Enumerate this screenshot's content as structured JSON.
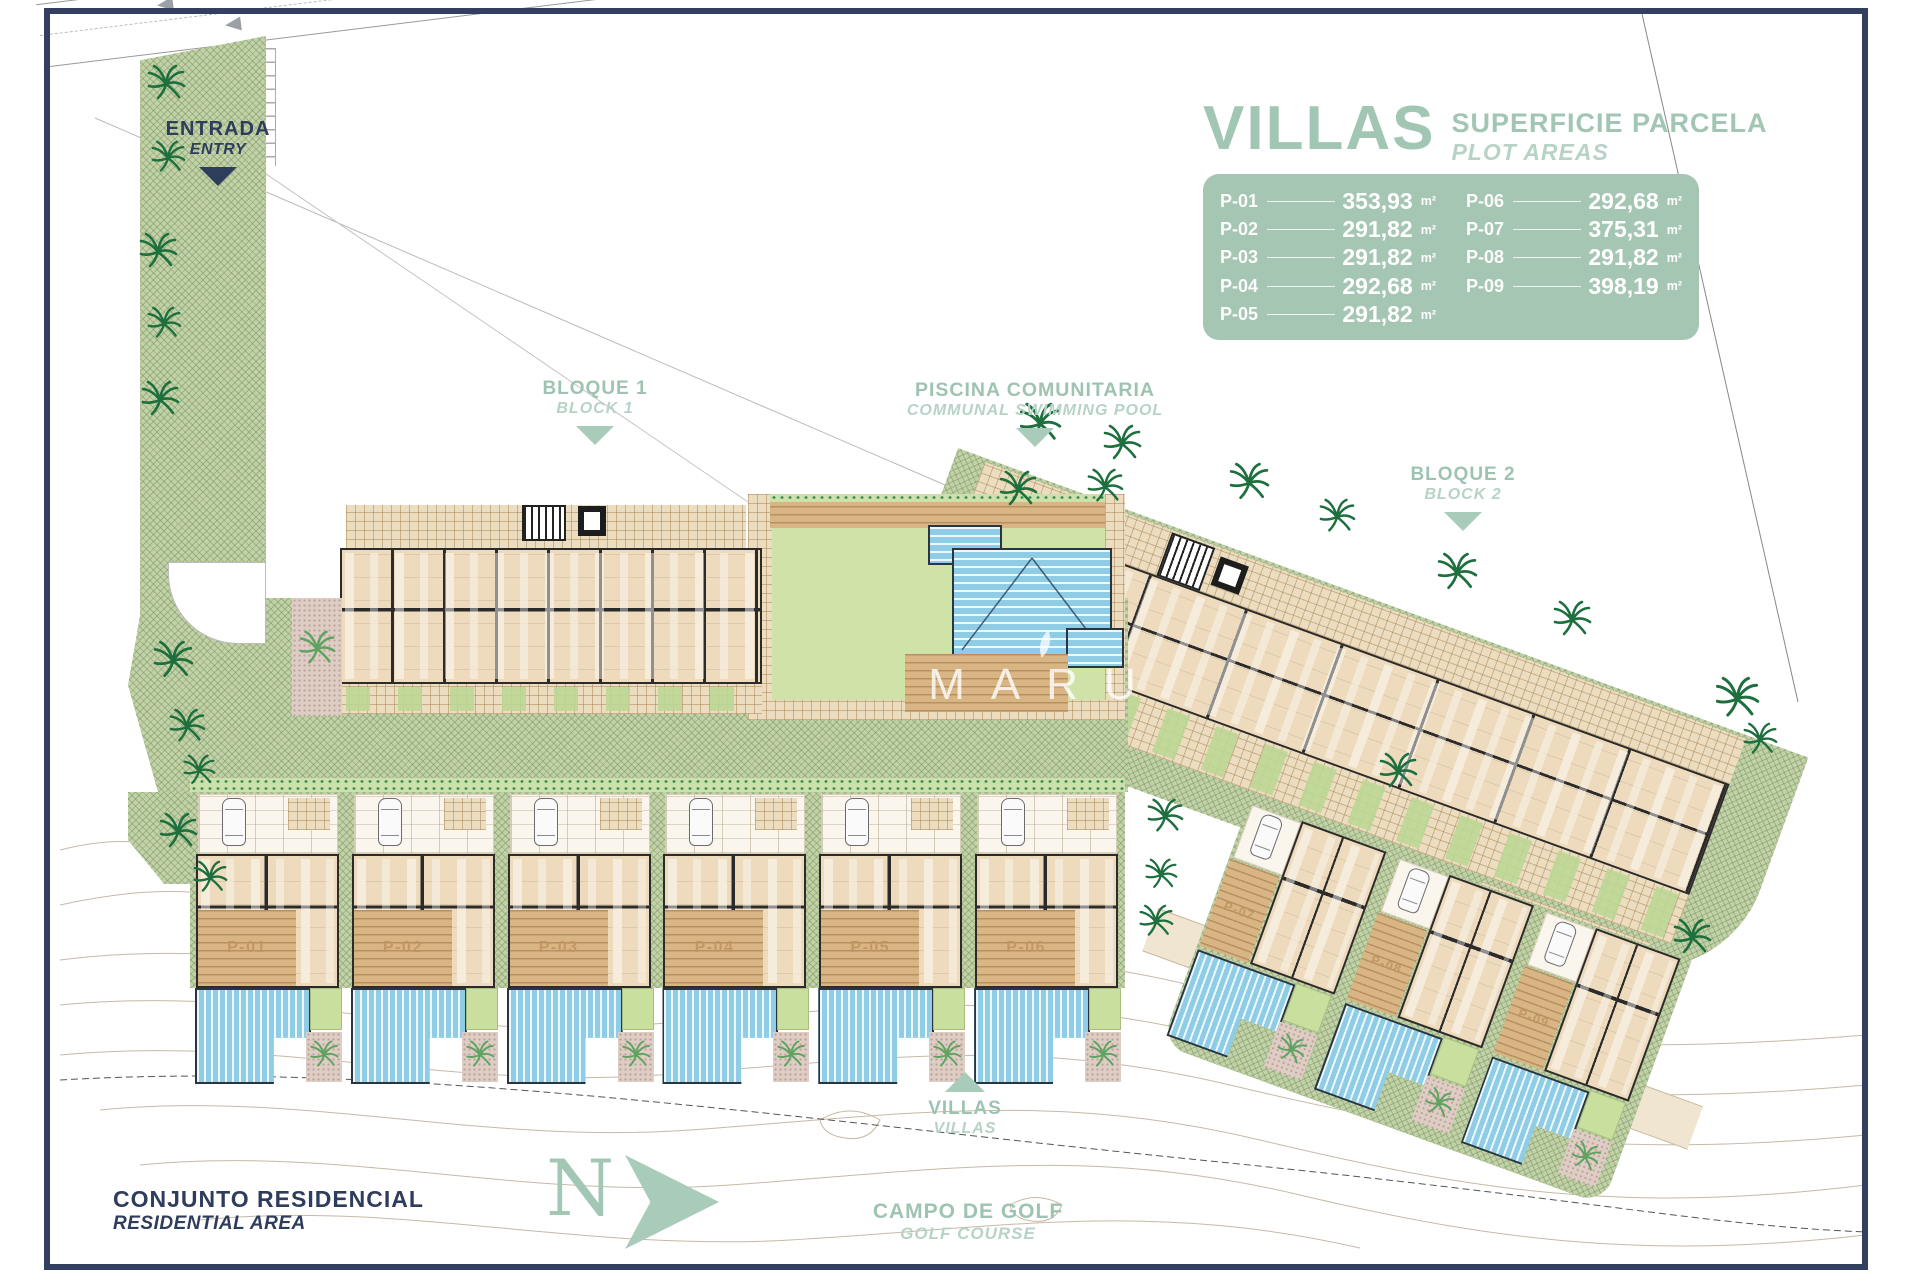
{
  "legend": {
    "title": "VILLAS",
    "subtitle_line1": "SUPERFICIE PARCELA",
    "subtitle_line2": "PLOT AREAS",
    "unit": "m²",
    "columns": [
      {
        "rows": [
          {
            "label": "P-01",
            "value": "353,93"
          },
          {
            "label": "P-02",
            "value": "291,82"
          },
          {
            "label": "P-03",
            "value": "291,82"
          },
          {
            "label": "P-04",
            "value": "292,68"
          },
          {
            "label": "P-05",
            "value": "291,82"
          }
        ]
      },
      {
        "rows": [
          {
            "label": "P-06",
            "value": "292,68"
          },
          {
            "label": "P-07",
            "value": "375,31"
          },
          {
            "label": "P-08",
            "value": "291,82"
          },
          {
            "label": "P-09",
            "value": "398,19"
          }
        ]
      }
    ]
  },
  "labels": {
    "entry": {
      "line1": "ENTRADA",
      "line2": "ENTRY"
    },
    "block1": {
      "line1": "BLOQUE 1",
      "line2": "BLOCK 1"
    },
    "pool": {
      "line1": "PISCINA COMUNITARIA",
      "line2": "COMMUNAL SWIMMING POOL"
    },
    "block2": {
      "line1": "BLOQUE 2",
      "line2": "BLOCK 2"
    },
    "villas": {
      "line1": "VILLAS",
      "line2": "VILLAS"
    },
    "golf": {
      "line1": "CAMPO DE GOLF",
      "line2": "GOLF COURSE"
    },
    "residential": {
      "line1": "CONJUNTO RESIDENCIAL",
      "line2": "RESIDENTIAL AREA"
    },
    "north": "N",
    "watermark": "MARU"
  },
  "plots": {
    "row1": [
      "P-01",
      "P-02",
      "P-03",
      "P-04",
      "P-05",
      "P-06"
    ],
    "row2": [
      "P-07",
      "P-08",
      "P-09"
    ]
  },
  "colors": {
    "accent_sage": "#a9cabb",
    "panel_green": "#a6c6b4",
    "navy": "#2e3d5c",
    "site_green": "#c2d1a8",
    "pool_blue": "#8fcce6",
    "deck_wood": "#d9b583",
    "building_beige": "#eedbbd",
    "wall_dark": "#2b2b2b",
    "palm_green": "#1e6f3e"
  }
}
